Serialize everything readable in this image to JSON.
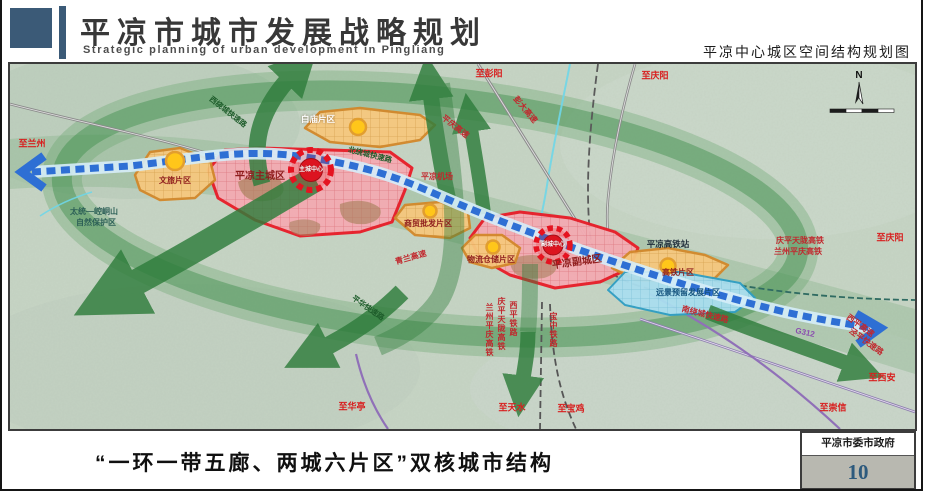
{
  "header": {
    "title_cn": "平凉市城市发展战略规划",
    "title_en": "Strategic planning of urban development in Pingliang",
    "map_title": "平凉中心城区空间结构规划图"
  },
  "footer": {
    "caption": "“一环一带五廊、两城六片区”双核城市结构",
    "agency": "平凉市委市政府",
    "page_number": "10"
  },
  "map": {
    "compass_n": "N",
    "labels": {
      "to_lanzhou": "至兰州",
      "nature_reserve_1": "太统—崆峒山",
      "nature_reserve_2": "自然保护区",
      "wenlv": "文旅片区",
      "main_city": "平凉主城区",
      "main_center": "主城中心",
      "baimiao": "白庙片区",
      "west_ring": "西绕城快速路",
      "north_ring": "北绕城快速路",
      "pingqing_expwy": "平庆高速",
      "pengda_expwy": "彭大高速",
      "to_pengyang": "至彭阳",
      "to_qingyang_top": "至庆阳",
      "airport": "平凉机场",
      "trade": "商贸批发片区",
      "qinglan_expwy": "青兰高速",
      "logistics": "物流仓储片区",
      "sub_city": "平凉副城区",
      "sub_center": "副城中心",
      "hsr_station": "平凉高铁站",
      "hsr_district": "高铁片区",
      "reserved": "远景预留发展片区",
      "south_ring": "南绕城快速路",
      "qptl_hsr_right": "庆平天陇高铁",
      "lzpq_hsr_right": "兰州平庆高铁",
      "to_qingyang_right": "至庆阳",
      "g312": "G312",
      "xiping_expwy": "西平高速",
      "jingping_expwy": "泾平快速路",
      "to_xian": "至西安",
      "to_chongxin": "至崇信",
      "pinghua_expwy": "平华快速路",
      "to_huating": "至华亭",
      "to_tianshui": "至天水",
      "to_baoji": "至宝鸡",
      "rail_lzpq": "兰州平庆高铁",
      "rail_qptl": "庆平天陇高铁",
      "rail_xiping": "西平铁路",
      "rail_baozhong": "宝中铁路"
    }
  },
  "colors": {
    "brand_blue": "#3b5a77",
    "district_red": "#e81c28",
    "district_orange": "#d3882a",
    "belt_blue": "#2e6fd4",
    "corridor_green": "#2f7d3c",
    "page_number_blue": "#2d5a7d"
  }
}
